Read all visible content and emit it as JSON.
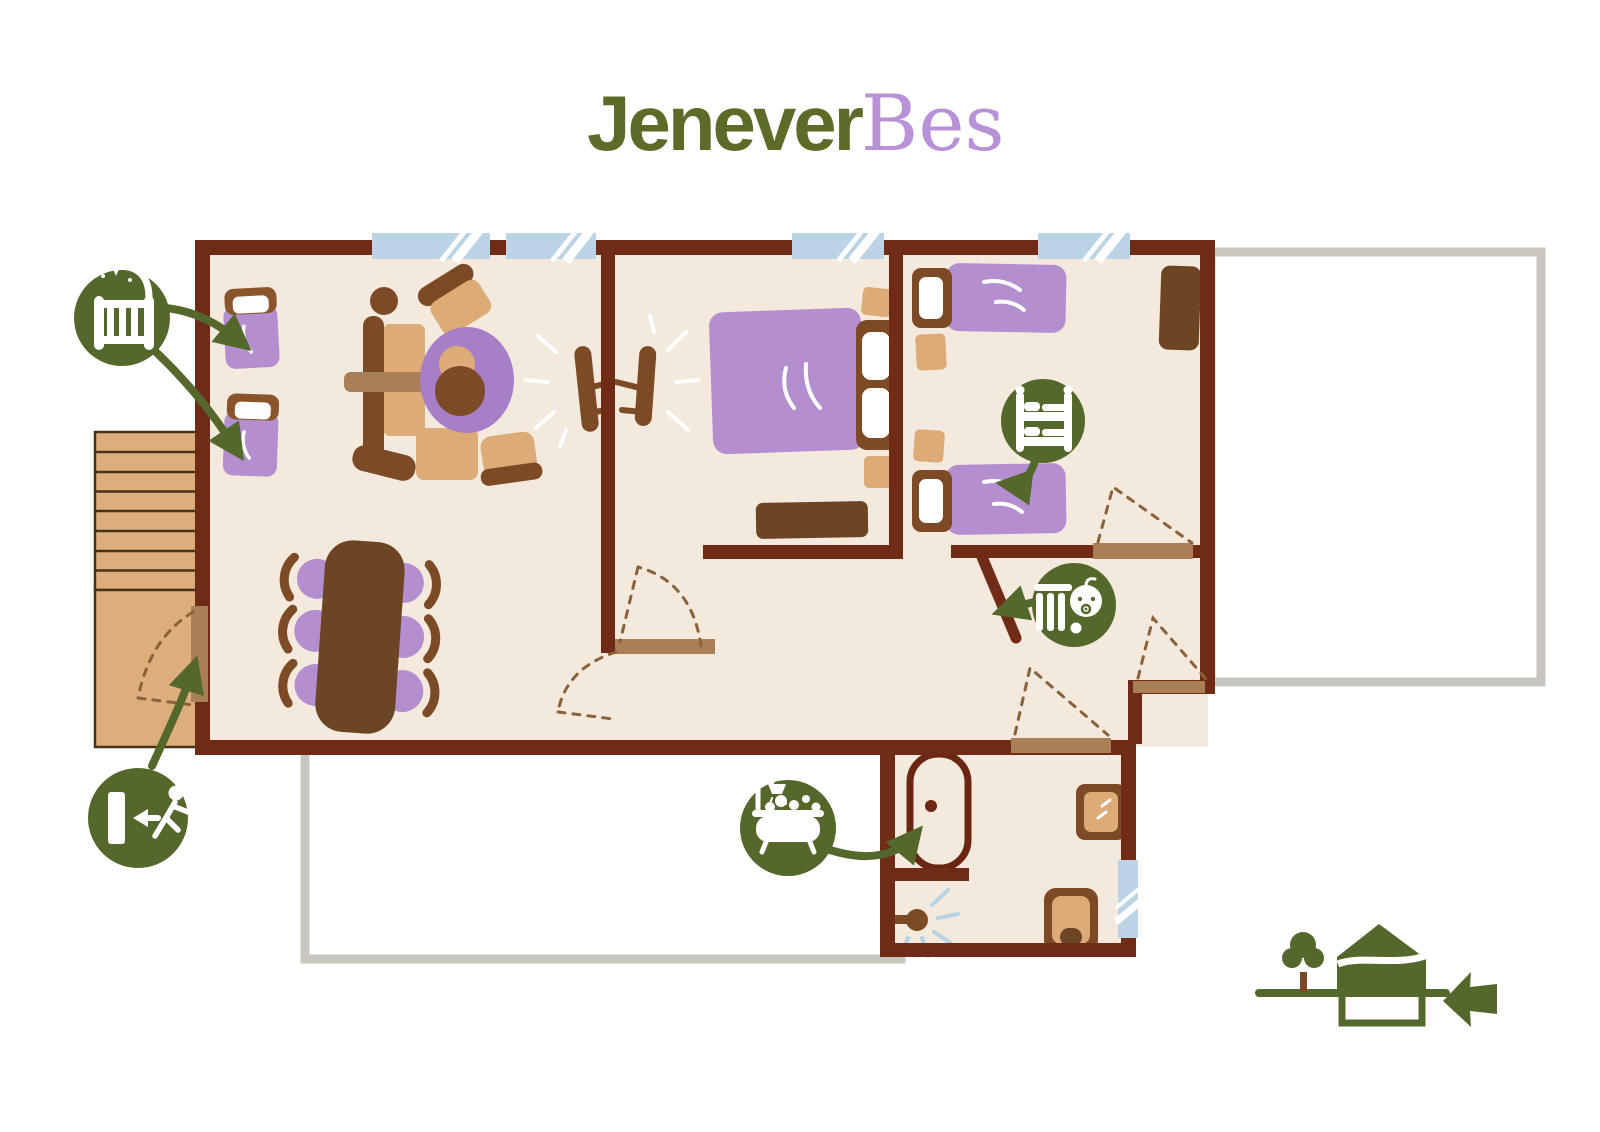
{
  "title": {
    "primary": "Jenever",
    "accent": "Bes"
  },
  "palette": {
    "title_green": "#5d6b28",
    "title_purple": "#b792d6",
    "wall_brown": "#6f2b15",
    "floor_beige": "#f3e9dc",
    "furniture_tan": "#dcab77",
    "furniture_brown": "#7d4a26",
    "furniture_dark_wood": "#6b4524",
    "door_light_wood": "#a97f56",
    "textile_purple": "#b48fd0",
    "rug_purple": "#a67fc7",
    "badge_green": "#55682c",
    "window_blue": "#bad3e5",
    "terrace_gray": "#c9c5bf",
    "dashed_line": "#8a6138"
  },
  "badges": [
    {
      "id": "baby-cot",
      "icon": "baby-cot-icon",
      "points_to": "two-cots-in-living-room"
    },
    {
      "id": "bunk-bed",
      "icon": "bunk-bed-icon",
      "points_to": "single-bed-in-right-bedroom"
    },
    {
      "id": "baby-gate",
      "icon": "baby-gate-icon",
      "points_to": "gate-in-hallway"
    },
    {
      "id": "bath",
      "icon": "bathtub-icon",
      "points_to": "bathtub-in-bathroom"
    },
    {
      "id": "exit",
      "icon": "exit-icon",
      "points_to": "door-to-outside-deck"
    }
  ],
  "floor_indicator": {
    "icon": "house-cross-section-icon",
    "highlighted_level": "upper",
    "arrow_direction": "left"
  }
}
